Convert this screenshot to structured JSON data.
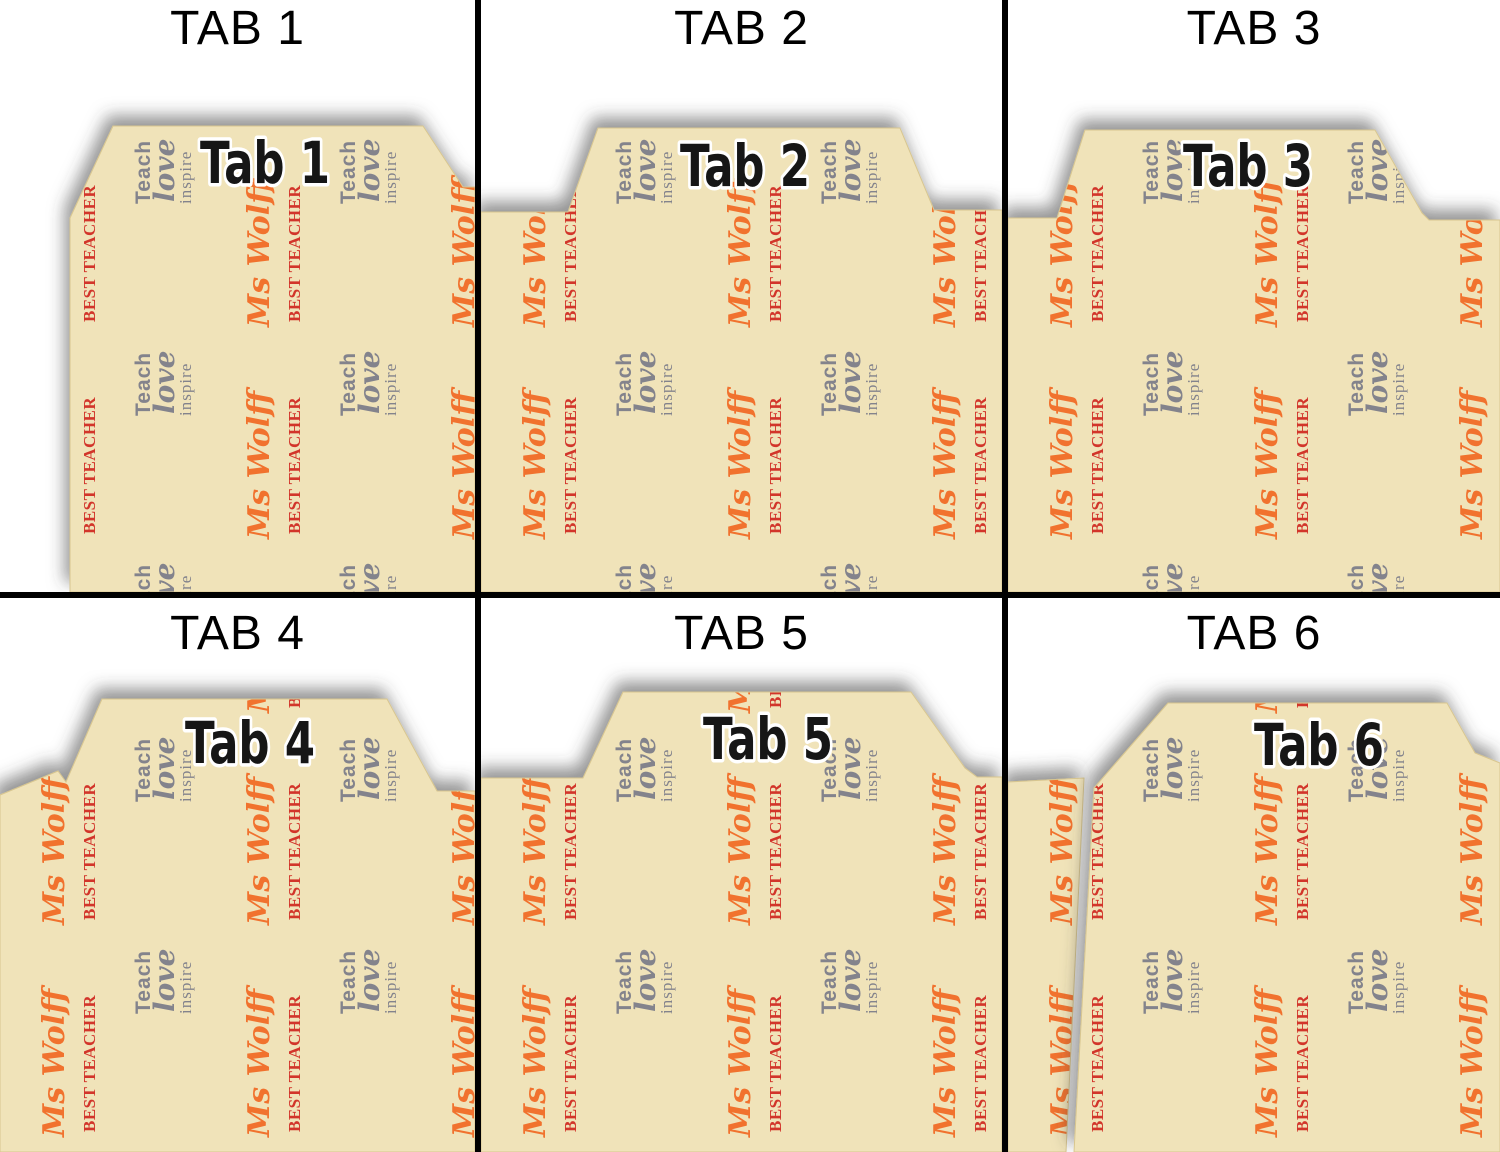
{
  "theme": {
    "page": "#ffffff",
    "line": "#000000",
    "folder": "#f0e3b9",
    "folderedge": "#d8c68f",
    "orange": "#f1722e",
    "red": "#d2342b",
    "gray": "#83838c",
    "tabink": "#161616",
    "tabhalo": "#ffffff",
    "header": "#000000"
  },
  "pattern": {
    "name_text": "Ms Wolff",
    "award_text": "BEST TEACHER",
    "motto_line1": "Teach",
    "motto_line2": "love",
    "motto_line3": "inspire"
  },
  "cells": [
    {
      "header": "TAB 1",
      "tab_label": "Tab 1"
    },
    {
      "header": "TAB 2",
      "tab_label": "Tab 2"
    },
    {
      "header": "TAB 3",
      "tab_label": "Tab 3"
    },
    {
      "header": "TAB 4",
      "tab_label": "Tab 4"
    },
    {
      "header": "TAB 5",
      "tab_label": "Tab 5"
    },
    {
      "header": "TAB 6",
      "tab_label": "Tab 6"
    }
  ]
}
